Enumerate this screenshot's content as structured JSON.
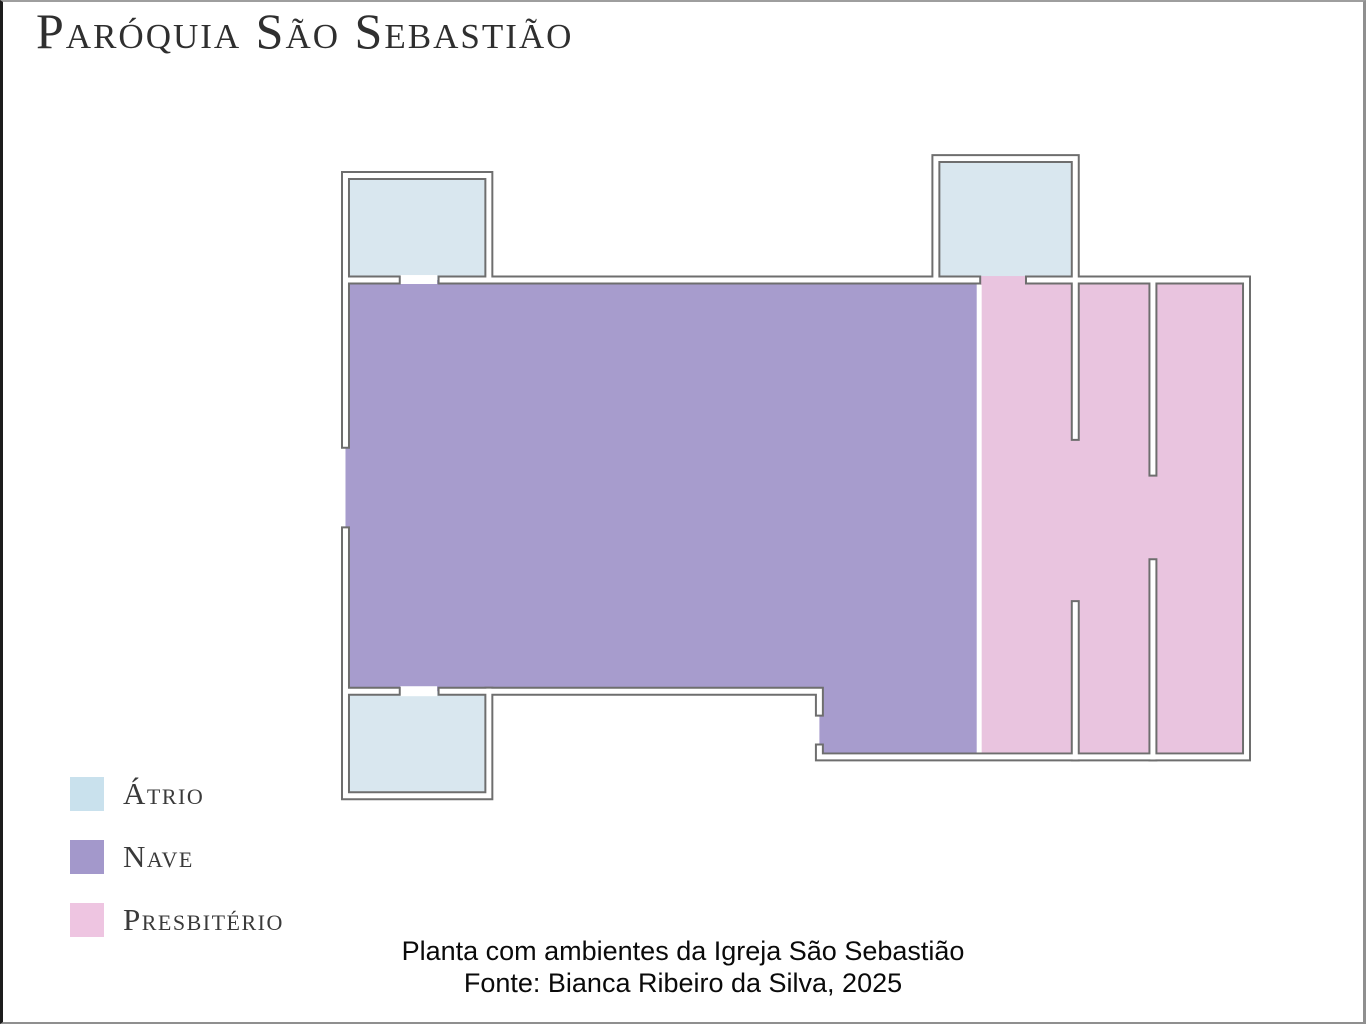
{
  "title": "Paróquia São Sebastião",
  "legend": {
    "items": [
      {
        "label": "Átrio",
        "color": "#c9e1ed"
      },
      {
        "label": "Nave",
        "color": "#a398cb"
      },
      {
        "label": "Presbitério",
        "color": "#eec5e1"
      }
    ]
  },
  "plan": {
    "colors": {
      "atrio_fill": "#d9e7ef",
      "nave_fill": "#a79ccd",
      "presbiterio_fill": "#e9c4df",
      "wall_line": "#6e6e6e",
      "door_gap": "#ffffff"
    },
    "rooms": [
      {
        "id": "atrio-top-left",
        "type": "Átrio"
      },
      {
        "id": "atrio-top-right",
        "type": "Átrio"
      },
      {
        "id": "atrio-bottom-left",
        "type": "Átrio"
      },
      {
        "id": "nave",
        "type": "Nave"
      },
      {
        "id": "presbiterio",
        "type": "Presbitério"
      }
    ]
  },
  "caption": {
    "line1": "Planta com ambientes da Igreja São Sebastião",
    "line2": "Fonte: Bianca Ribeiro da Silva, 2025"
  }
}
